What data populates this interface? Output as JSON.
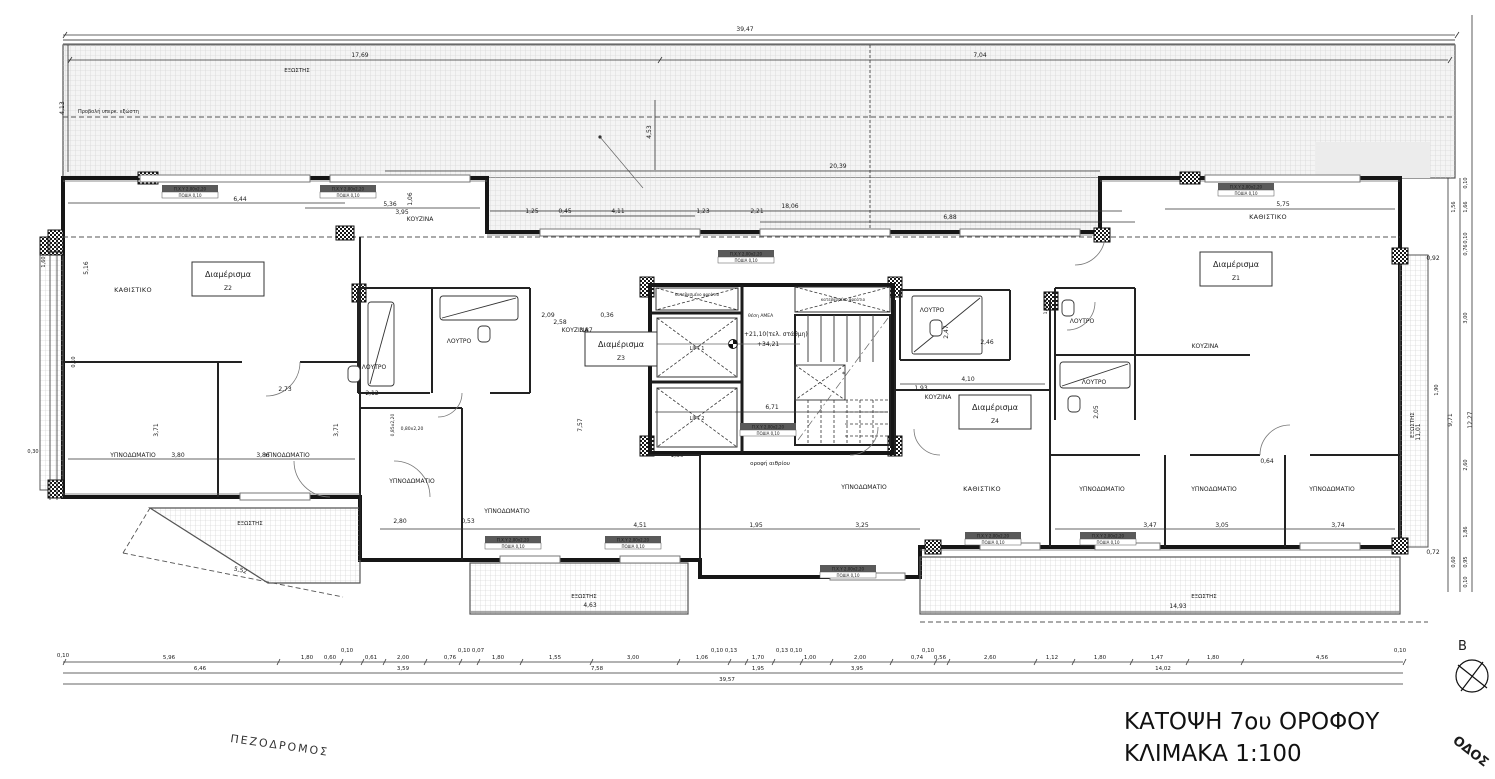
{
  "meta": {
    "title": "ΚΑΤΟΨΗ 7ου ΟΡΟΦΟΥ",
    "scale": "ΚΛΙΜΑΚΑ 1:100",
    "north_label": "B",
    "street_pedestrian": "ΠΕΖΟΔΡΟΜΟΣ",
    "street_road": "ΟΔΟΣ",
    "projection_note": "Προβολή υπερκ. εξώστη"
  },
  "apartments": {
    "label": "Διαμέρισμα",
    "z1": "Z1",
    "z2": "Z2",
    "z3": "Z3",
    "z4": "Z4"
  },
  "rooms": {
    "living": "ΚΑΘΙΣΤΙΚΟ",
    "kitchen": "ΚΟΥΖΙΝΑ",
    "bath": "ΛΟΥΤΡΟ",
    "bedroom": "ΥΠΝΟΔΩΜΑΤΙΟ",
    "balcony": "ΕΞΩΣΤΗΣ"
  },
  "core": {
    "lift1": "LIFT 1",
    "lift2": "LIFT 2",
    "level_top": "+21,10(τελ. στάθμη)",
    "level_bottom": "+34,21",
    "shaft": "κατεβασμένο φρεάτιο",
    "amea": "θέση ΑΜΕΑ",
    "atrium": "οροφή αιθρίου",
    "width": "6,71",
    "stair": "1,80"
  },
  "window_tag": {
    "l1": "Π.Χ.Υ 2,00x2,20",
    "l2": "ΠΟΔΙΑ 0,10"
  },
  "doors": {
    "d085": "0,85x2,20",
    "d100": "1,00x2,20",
    "d080": "0,80x2,20"
  },
  "dims": {
    "top_total": "39,47",
    "top_left": "17,69",
    "top_right": "7,04",
    "mid_band": "20,39",
    "v_left": "4,13",
    "v_mid": "4,53",
    "upper": {
      "a": "6,44",
      "b": "5,36",
      "c": "3,95",
      "d": "1,25",
      "e": "0,45",
      "f": "4,11",
      "g": "1,23",
      "h": "2,21",
      "i": "18,06",
      "j": "6,88",
      "k": "5,75",
      "l": "1,06"
    },
    "plan": [
      "2,73",
      "2,12",
      "2,80",
      "0,53",
      "4,51",
      "1,95",
      "3,25",
      "1,93",
      "4,10",
      "2,46",
      "3,47",
      "3,05",
      "3,74",
      "0,64",
      "2,09",
      "2,58",
      "3,87",
      "0,36",
      "3,80",
      "3,86",
      "5,52",
      "4,63",
      "14,93",
      "5,16",
      "3,71",
      "3,71",
      "7,57",
      "11,01",
      "12,27",
      "9,71",
      "2,05",
      "2,47",
      "0,92",
      "0,72"
    ],
    "right": [
      "0,10",
      "1,56",
      "1,66",
      "0,10",
      "0,76",
      "3,00",
      "1,90",
      "2,60",
      "1,86",
      "0,60",
      "0,95",
      "0,10"
    ],
    "left": [
      "1,60",
      "0,30",
      "0,10"
    ],
    "bottom1": [
      "0,10",
      "5,96",
      "1,80",
      "0,60",
      "0,10",
      "0,61",
      "2,00",
      "0,76",
      "0,10",
      "0,07",
      "1,80",
      "1,55",
      "3,00",
      "1,06",
      "0,10",
      "0,13",
      "1,70",
      "0,13",
      "0,10",
      "1,00",
      "2,00",
      "0,74",
      "0,10",
      "0,56",
      "2,60",
      "1,12",
      "1,80",
      "1,47",
      "1,80",
      "4,56",
      "0,10"
    ],
    "bottom2": [
      "6,46",
      "3,59",
      "7,58",
      "1,95",
      "3,95",
      "14,02"
    ],
    "bottom3": "39,57"
  }
}
